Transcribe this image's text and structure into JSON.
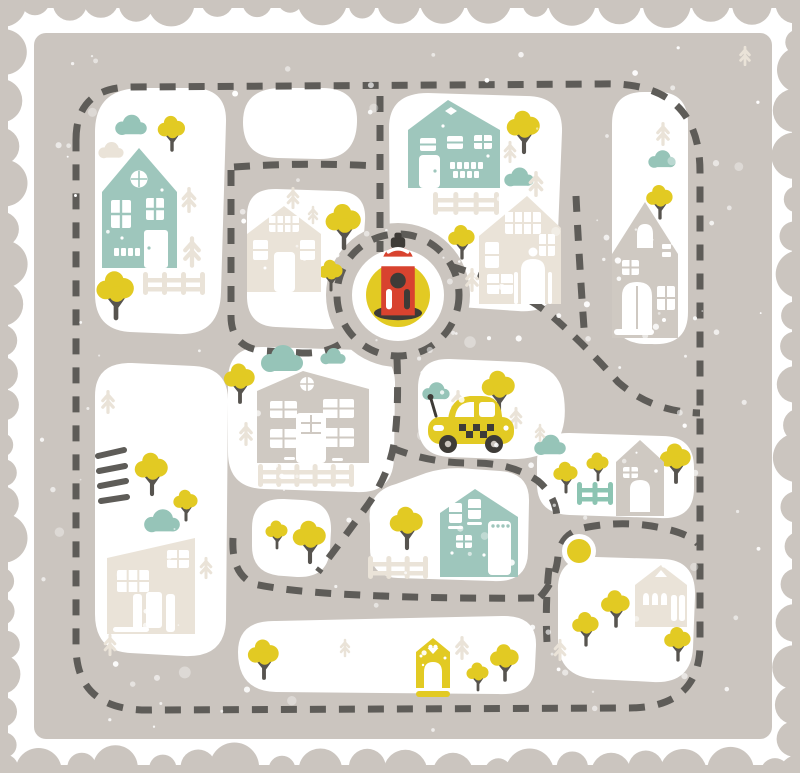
{
  "scene_type": "illustrated-town-play-mat-map",
  "palette": {
    "mat": "#CBC5BF",
    "block": "#FFFFFF",
    "dash": "#5E5C58",
    "teal": "#9EC6BC",
    "teal_bush": "#96C4B8",
    "teal_fence": "#8CC4B2",
    "yellow": "#E2CA23",
    "red": "#D8432F",
    "cream": "#EAE3D8",
    "gray_house": "#CFC9C2",
    "dark": "#57544F",
    "wheel": "#3E3B37"
  },
  "border": {
    "r_min": 12,
    "r_var": 13,
    "gap_min": 14,
    "gap_var": 12
  },
  "speckles": {
    "seed": 42,
    "small": 170,
    "large": 14
  },
  "roundabout": {
    "cx": 398,
    "cy": 295,
    "r_road": 72,
    "r_island": 46,
    "r_inner": 32,
    "r_dash": 61
  },
  "scene": {
    "pond": {
      "cx": 579,
      "cy": 551,
      "r_ring": 17,
      "r_fill": 12
    },
    "hydrant": {
      "cx": 398,
      "cy": 313,
      "s": 1.2
    },
    "taxi": {
      "x": 428,
      "y": 390
    },
    "houses": [
      {
        "type": "teal-tall",
        "x": 102,
        "y": 148
      },
      {
        "type": "teal-wide",
        "x": 408,
        "y": 98
      },
      {
        "type": "cream-big",
        "x": 479,
        "y": 196
      },
      {
        "type": "cream-mid",
        "x": 247,
        "y": 206
      },
      {
        "type": "gray-tall",
        "x": 612,
        "y": 202
      },
      {
        "type": "gray-wide",
        "x": 257,
        "y": 371
      },
      {
        "type": "cream-slant",
        "x": 107,
        "y": 534
      },
      {
        "type": "teal-corner",
        "x": 440,
        "y": 489
      },
      {
        "type": "gray-small",
        "x": 616,
        "y": 440
      },
      {
        "type": "cream-small",
        "x": 635,
        "y": 563
      },
      {
        "type": "yellow-kennel",
        "x": 416,
        "y": 636
      }
    ],
    "trees": [
      {
        "x": 172,
        "y": 150,
        "s": 0.62
      },
      {
        "x": 116,
        "y": 318,
        "s": 0.85
      },
      {
        "x": 344,
        "y": 248,
        "s": 0.8
      },
      {
        "x": 331,
        "y": 290,
        "s": 0.55
      },
      {
        "x": 524,
        "y": 152,
        "s": 0.75
      },
      {
        "x": 462,
        "y": 258,
        "s": 0.6
      },
      {
        "x": 660,
        "y": 218,
        "s": 0.6
      },
      {
        "x": 240,
        "y": 402,
        "s": 0.7
      },
      {
        "x": 499,
        "y": 412,
        "s": 0.75
      },
      {
        "x": 152,
        "y": 494,
        "s": 0.75
      },
      {
        "x": 186,
        "y": 520,
        "s": 0.55
      },
      {
        "x": 310,
        "y": 562,
        "s": 0.75
      },
      {
        "x": 277,
        "y": 548,
        "s": 0.5
      },
      {
        "x": 407,
        "y": 548,
        "s": 0.75
      },
      {
        "x": 566,
        "y": 492,
        "s": 0.55
      },
      {
        "x": 598,
        "y": 480,
        "s": 0.5
      },
      {
        "x": 676,
        "y": 482,
        "s": 0.7
      },
      {
        "x": 264,
        "y": 678,
        "s": 0.7
      },
      {
        "x": 478,
        "y": 690,
        "s": 0.5
      },
      {
        "x": 505,
        "y": 680,
        "s": 0.65
      },
      {
        "x": 586,
        "y": 645,
        "s": 0.6
      },
      {
        "x": 616,
        "y": 626,
        "s": 0.65
      },
      {
        "x": 678,
        "y": 660,
        "s": 0.6
      }
    ],
    "firs": [
      {
        "x": 189,
        "y": 200,
        "s": 0.7
      },
      {
        "x": 192,
        "y": 252,
        "s": 0.85
      },
      {
        "x": 293,
        "y": 198,
        "s": 0.6
      },
      {
        "x": 313,
        "y": 215,
        "s": 0.5
      },
      {
        "x": 510,
        "y": 152,
        "s": 0.6
      },
      {
        "x": 536,
        "y": 184,
        "s": 0.7
      },
      {
        "x": 472,
        "y": 280,
        "s": 0.65
      },
      {
        "x": 663,
        "y": 134,
        "s": 0.65
      },
      {
        "x": 458,
        "y": 402,
        "s": 0.65
      },
      {
        "x": 516,
        "y": 418,
        "s": 0.6
      },
      {
        "x": 540,
        "y": 433,
        "s": 0.5
      },
      {
        "x": 246,
        "y": 434,
        "s": 0.65
      },
      {
        "x": 108,
        "y": 402,
        "s": 0.65
      },
      {
        "x": 206,
        "y": 568,
        "s": 0.6
      },
      {
        "x": 110,
        "y": 645,
        "s": 0.6
      },
      {
        "x": 345,
        "y": 648,
        "s": 0.5
      },
      {
        "x": 462,
        "y": 648,
        "s": 0.65
      },
      {
        "x": 560,
        "y": 650,
        "s": 0.6
      },
      {
        "x": 745,
        "y": 56,
        "s": 0.55
      }
    ],
    "clouds_teal": [
      {
        "x": 131,
        "y": 126,
        "s": 0.75
      },
      {
        "x": 282,
        "y": 360,
        "s": 1.0
      },
      {
        "x": 333,
        "y": 357,
        "s": 0.6
      },
      {
        "x": 519,
        "y": 178,
        "s": 0.7
      },
      {
        "x": 662,
        "y": 160,
        "s": 0.65
      },
      {
        "x": 436,
        "y": 392,
        "s": 0.65
      },
      {
        "x": 550,
        "y": 446,
        "s": 0.75
      },
      {
        "x": 162,
        "y": 522,
        "s": 0.85
      }
    ],
    "clouds_cream": [
      {
        "x": 111,
        "y": 151,
        "s": 0.6
      }
    ],
    "fences": [
      {
        "x": 143,
        "y": 272,
        "w": 62,
        "c": "cream"
      },
      {
        "x": 433,
        "y": 192,
        "w": 66,
        "c": "cream"
      },
      {
        "x": 258,
        "y": 464,
        "w": 96,
        "c": "cream"
      },
      {
        "x": 368,
        "y": 556,
        "w": 60,
        "c": "cream"
      },
      {
        "x": 577,
        "y": 482,
        "w": 36,
        "c": "teal"
      }
    ]
  }
}
